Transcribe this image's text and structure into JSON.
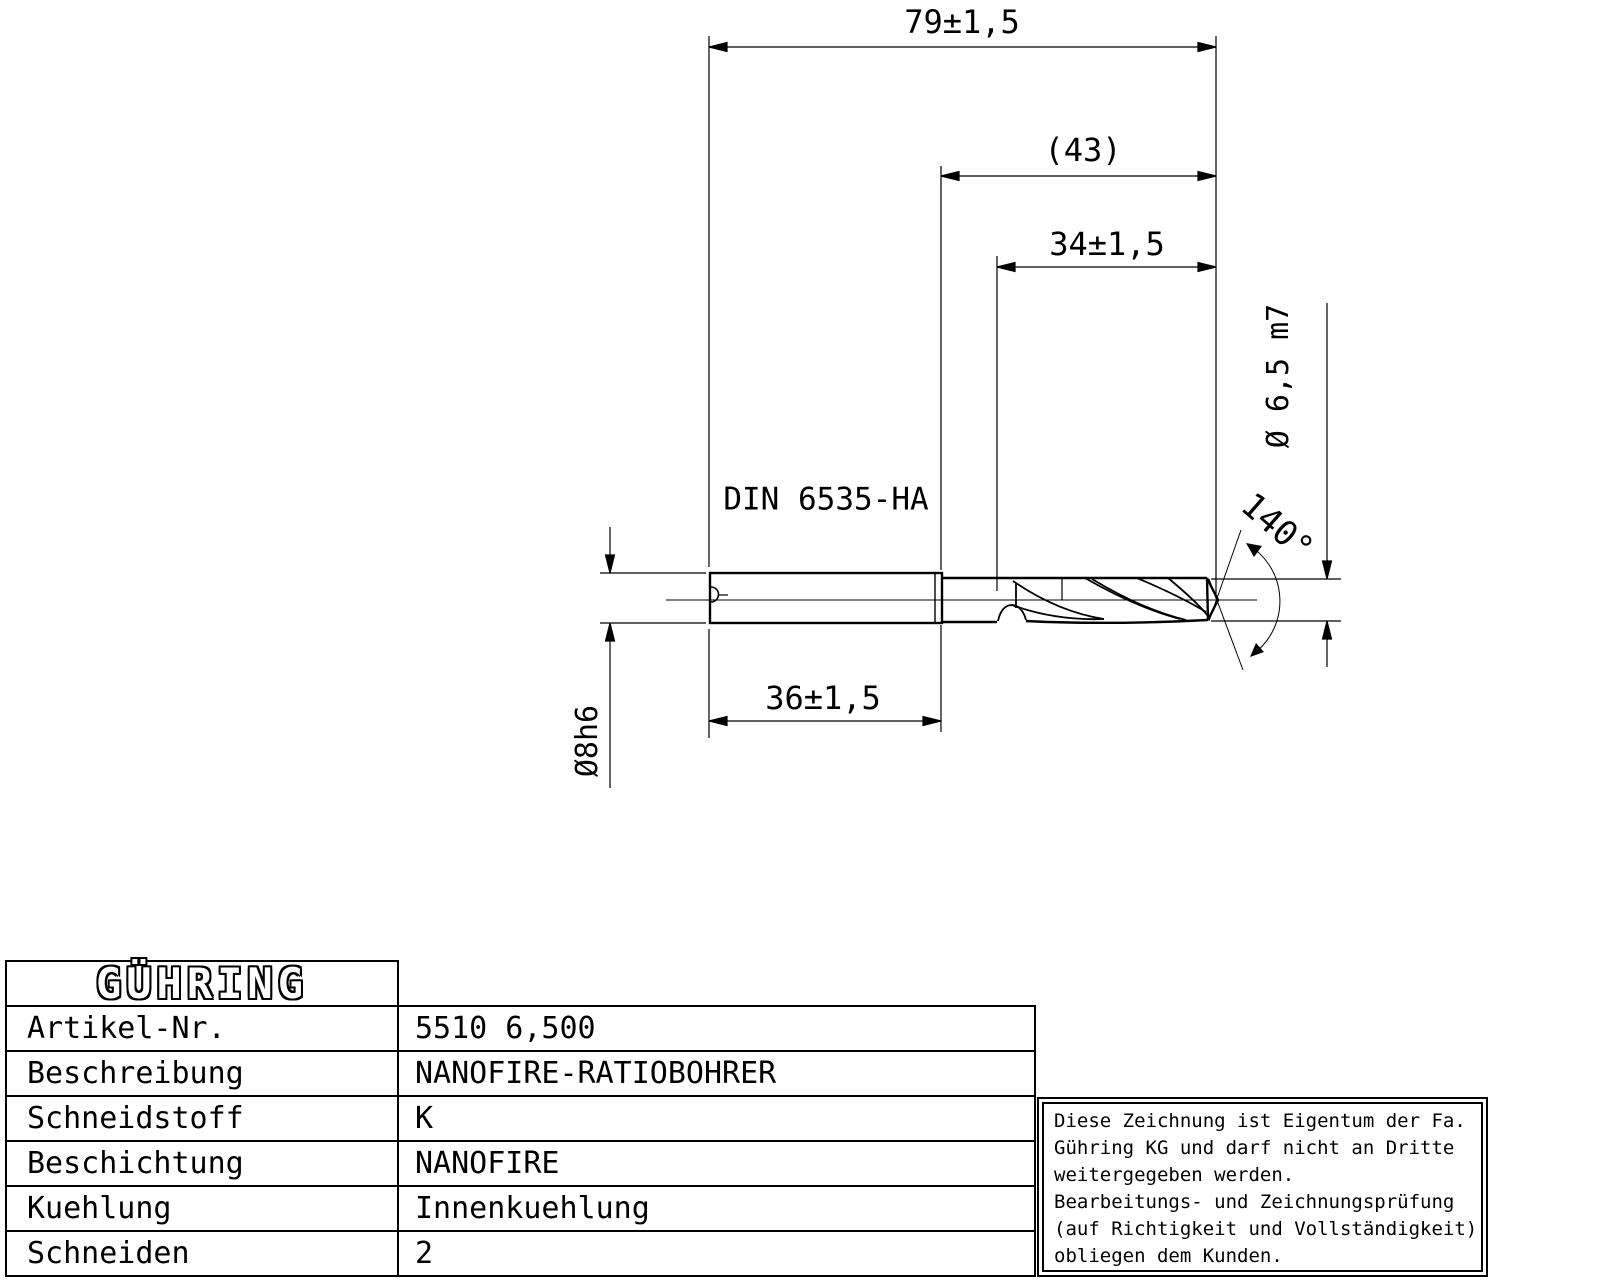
{
  "drawing": {
    "standard_label": "DIN 6535-HA",
    "dimensions": {
      "overall_length": "79±1,5",
      "reference_length": "(43)",
      "flute_length": "34±1,5",
      "shank_length": "36±1,5",
      "shank_diameter": "Ø8h6",
      "cutting_diameter": "Ø 6,5 m7",
      "point_angle": "140°"
    }
  },
  "title_block": {
    "logo": "GÜHRING",
    "rows": [
      {
        "label": "Artikel-Nr.",
        "value": "5510 6,500"
      },
      {
        "label": "Beschreibung",
        "value": "NANOFIRE-RATIOBOHRER"
      },
      {
        "label": "Schneidstoff",
        "value": "K"
      },
      {
        "label": "Beschichtung",
        "value": "NANOFIRE"
      },
      {
        "label": "Kuehlung",
        "value": "Innenkuehlung"
      },
      {
        "label": "Schneiden",
        "value": "2"
      }
    ]
  },
  "note_box": {
    "lines": [
      "Diese Zeichnung ist Eigentum der Fa.",
      "Gühring KG und darf nicht an Dritte",
      "weitergegeben werden.",
      "Bearbeitungs- und Zeichnungsprüfung",
      "(auf Richtigkeit und Vollständigkeit)",
      "obliegen dem Kunden."
    ]
  },
  "colors": {
    "ink": "#000000",
    "paper": "#ffffff"
  }
}
